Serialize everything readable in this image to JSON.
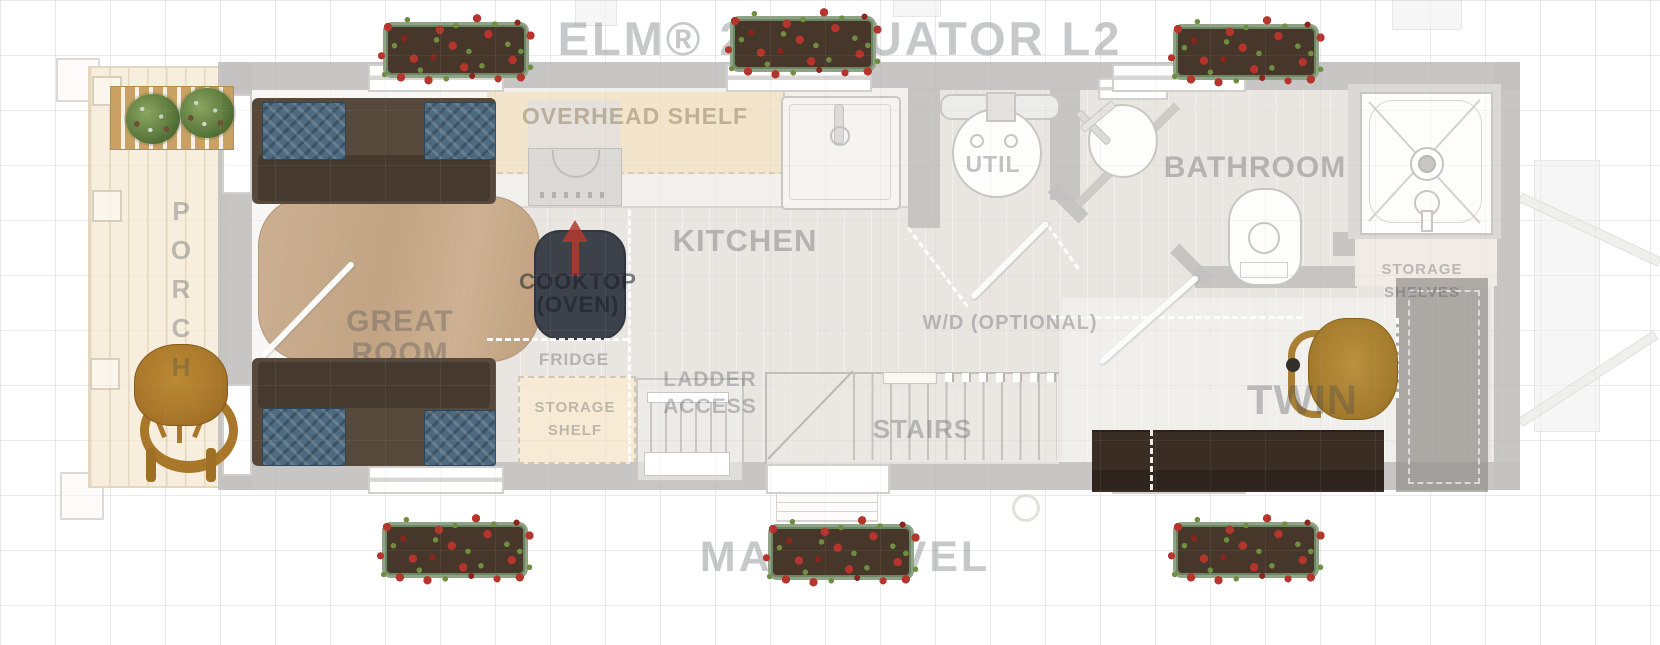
{
  "title": "ELM® 26 EQUATOR L2",
  "level_label": "MAIN LEVEL",
  "rooms": {
    "porch": "PORCH",
    "great_room": {
      "line1": "GREAT",
      "line2": "ROOM"
    },
    "kitchen": "KITCHEN",
    "util": "UTIL",
    "stairs": "STAIRS",
    "bathroom": "BATHROOM",
    "twin": "TWIN"
  },
  "features": {
    "overhead_shelf": "OVERHEAD SHELF",
    "cooktop": {
      "line1": "COOKTOP",
      "line2": "(OVEN)"
    },
    "fridge": "FRIDGE",
    "storage_shelf": {
      "line1": "STORAGE",
      "line2": "SHELF"
    },
    "ladder_access": {
      "line1": "LADDER",
      "line2": "ACCESS"
    },
    "wd_optional": "W/D (OPTIONAL)",
    "storage_shelves": {
      "line1": "STORAGE",
      "line2": "SHELVES"
    }
  },
  "colors": {
    "label_gray": "#b9bcbf",
    "wall_gray": "#c3c2c0",
    "flower_red": "#b5342c",
    "planter_green": "#8fa486",
    "table_wood": "#c9ac8d",
    "porch_wood": "#f6eedd",
    "sofa_brown": "#4b3e32",
    "cushion_blue": "#4d6a80",
    "chair_wood": "#ad8136",
    "desk_brown": "#382c23",
    "arrow_red": "#b23a30"
  }
}
